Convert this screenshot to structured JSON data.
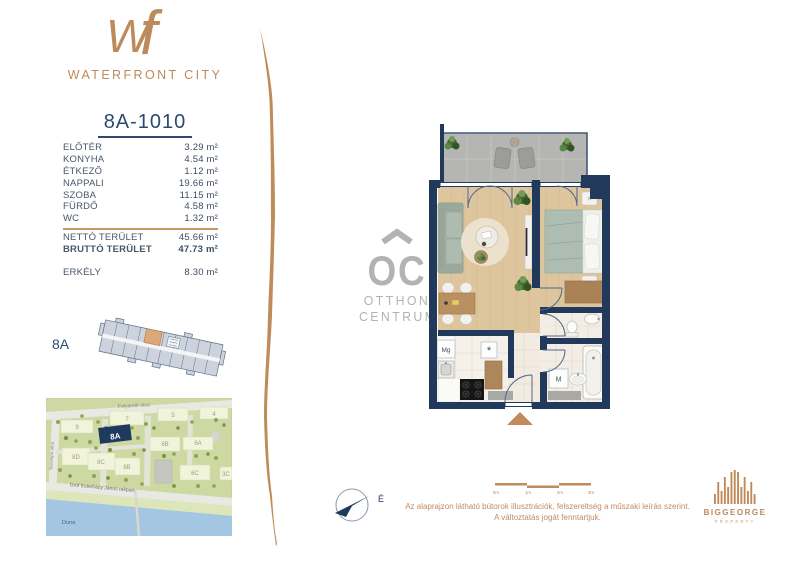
{
  "brand": {
    "monogram": {
      "w": "W",
      "f": "f"
    },
    "name": "WATERFRONT CITY"
  },
  "unit": {
    "id": "8A-1010",
    "areas": [
      {
        "label": "ELŐTÉR",
        "value": "3.29 m²"
      },
      {
        "label": "KONYHA",
        "value": "4.54 m²"
      },
      {
        "label": "ÉTKEZŐ",
        "value": "1.12 m²"
      },
      {
        "label": "NAPPALI",
        "value": "19.66 m²"
      },
      {
        "label": "SZOBA",
        "value": "11.15 m²"
      },
      {
        "label": "FÜRDŐ",
        "value": "4.58 m²"
      },
      {
        "label": "WC",
        "value": "1.32 m²"
      }
    ],
    "totals": [
      {
        "label": "NETTÓ TERÜLET",
        "value": "45.66 m²"
      },
      {
        "label": "BRUTTÓ TERÜLET",
        "value": "47.73 m²"
      }
    ],
    "balcony": {
      "label": "ERKÉLY",
      "value": "8.30 m²"
    }
  },
  "floorplate": {
    "unit_label": "8A"
  },
  "map": {
    "streets": [
      {
        "label": "Folyamőr utca"
      },
      {
        "label": "Sorompó utca"
      },
      {
        "label": "Gróf Esterházy János rakpart"
      }
    ],
    "river_label": "Duna",
    "highlight_label": "8A",
    "buildings": [
      {
        "label": "9"
      },
      {
        "label": "7"
      },
      {
        "label": "5"
      },
      {
        "label": "4"
      },
      {
        "label": "8D"
      },
      {
        "label": "8C"
      },
      {
        "label": "8B"
      },
      {
        "label": "6B"
      },
      {
        "label": "6A"
      },
      {
        "label": "6C"
      },
      {
        "label": "3C"
      }
    ]
  },
  "watermark": {
    "monogram": "OC",
    "line1": "OTTHON",
    "line2": "CENTRUM"
  },
  "floorplan": {
    "appliances": {
      "fridge": "Mg",
      "dishwasher": "*",
      "washer": "M"
    }
  },
  "compass": {
    "north_label": "É"
  },
  "scalebar": {
    "ticks": [
      "0m",
      "1m",
      "2m",
      "3m"
    ]
  },
  "footer": {
    "disclaimer_line1": "Az alaprajzon látható bútorok illusztrációk, felszereltség a műszaki leírás szerint.",
    "disclaimer_line2": "A változtatás jogát fenntartjuk."
  },
  "developer": {
    "name": "BIGGEORGE",
    "division": "PROPERTY"
  },
  "colors": {
    "accent": "#c08a5a",
    "navy": "#21395a",
    "highlight_unit": "#dba87c"
  }
}
